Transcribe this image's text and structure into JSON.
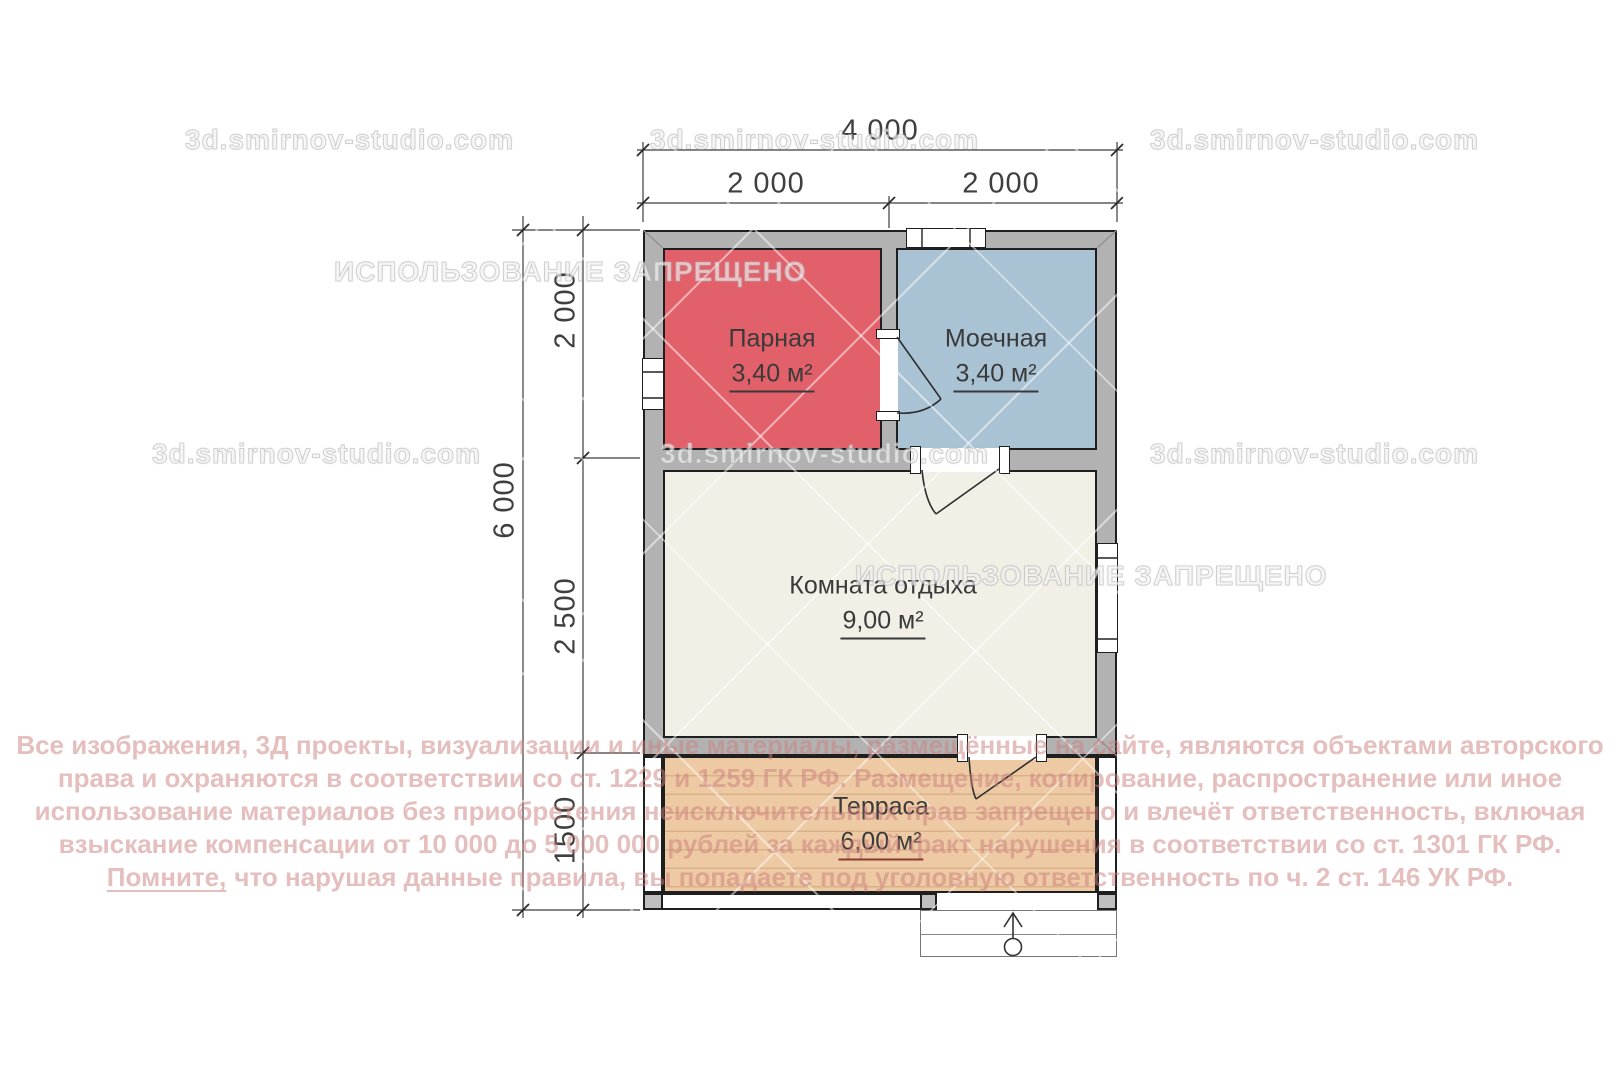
{
  "watermarks": {
    "site": "3d.smirnov-studio.com",
    "ban": "ИСПОЛЬЗОВАНИЕ ЗАПРЕЩЕНО"
  },
  "dimensions": {
    "top_total": "4 000",
    "top_left": "2 000",
    "top_right": "2 000",
    "left_total": "6 000",
    "left_upper": "2 000",
    "left_middle": "2 500",
    "left_lower": "1500"
  },
  "rooms": {
    "parnaya": {
      "name": "Парная",
      "area": "3,40 м²"
    },
    "moechnaya": {
      "name": "Моечная",
      "area": "3,40 м²"
    },
    "komnata": {
      "name": "Комната отдыха",
      "area": "9,00 м²"
    },
    "terrasa": {
      "name": "Терраса",
      "area": "6,00 м²"
    }
  },
  "disclaimer": {
    "line1": "Все изображения, 3Д проекты, визуализации и иные материалы, размещённые на сайте, являются объектами авторского",
    "line2": "права и охраняются в соответствии со ст. 1229 и 1259 ГК РФ. Размещение, копирование, распространение или иное",
    "line3": "использование материалов без приобретения неисключительных прав запрещено и влечёт ответственность, включая",
    "line4": "взыскание компенсации от 10 000 до 5 000 000 рублей за каждый факт нарушения в соответствии со ст. 1301 ГК РФ.",
    "line5_lead": "Помните,",
    "line5_rest": "что нарушая данные правила, вы попадаете под уголовную ответственность по ч. 2 ст. 146 УК РФ."
  },
  "colors": {
    "room-red": "#e2606a",
    "room-blue": "#a9c3d4",
    "room-cream": "#f2efe7",
    "terrace-wood": "#edcaa3",
    "terrace-plank": "#d9b189",
    "wall-gray": "#b2b2b2",
    "dim-text": "#3f3f3f",
    "terrace-underline": "#8a3b30",
    "disclaimer-pink": "#cb7d7d80"
  }
}
